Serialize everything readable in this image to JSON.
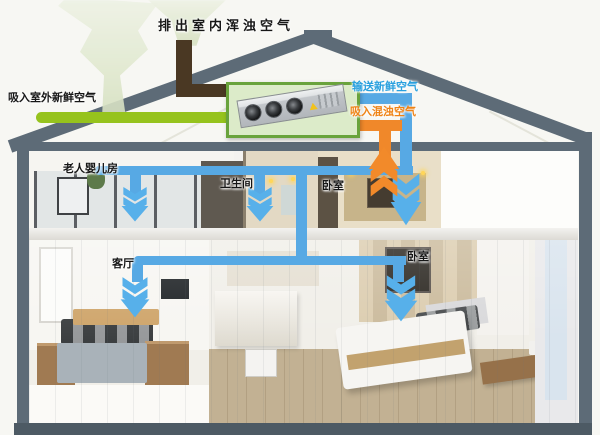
{
  "flow_labels": {
    "exhaust_outdoor": "排出室内浑浊空气",
    "intake_outdoor": "吸入室外新鲜空气",
    "supply_fresh": "输送新鲜空气",
    "return_stale": "吸入混浊空气"
  },
  "rooms": {
    "elderly_baby": "老人婴儿房",
    "bathroom": "卫生间",
    "bedroom_upper": "卧室",
    "living_room": "客厅",
    "bedroom_lower": "卧室"
  },
  "colors": {
    "frame_slate": "#5d6b77",
    "ground_band": "#4d5a64",
    "intake_pipe_green": "#96c31d",
    "exhaust_pipe_brown": "#4a3823",
    "supply_pipe_blue": "#57a9e4",
    "return_pipe_orange": "#f0882a",
    "supply_text_blue": "#29a0de",
    "return_text_orange": "#ef8316",
    "unit_box_fill": "#dcebc9",
    "unit_box_border": "#69a33c",
    "background": "#f7f7f3"
  },
  "icons": {
    "supply_arrow": "chevron-down-arrow",
    "return_arrow": "chevron-up-arrow",
    "intake_cloud": "air-funnel",
    "exhaust_cloud": "air-funnel",
    "unit_fan": "fan-circle",
    "unit_warning": "warning-triangle"
  }
}
